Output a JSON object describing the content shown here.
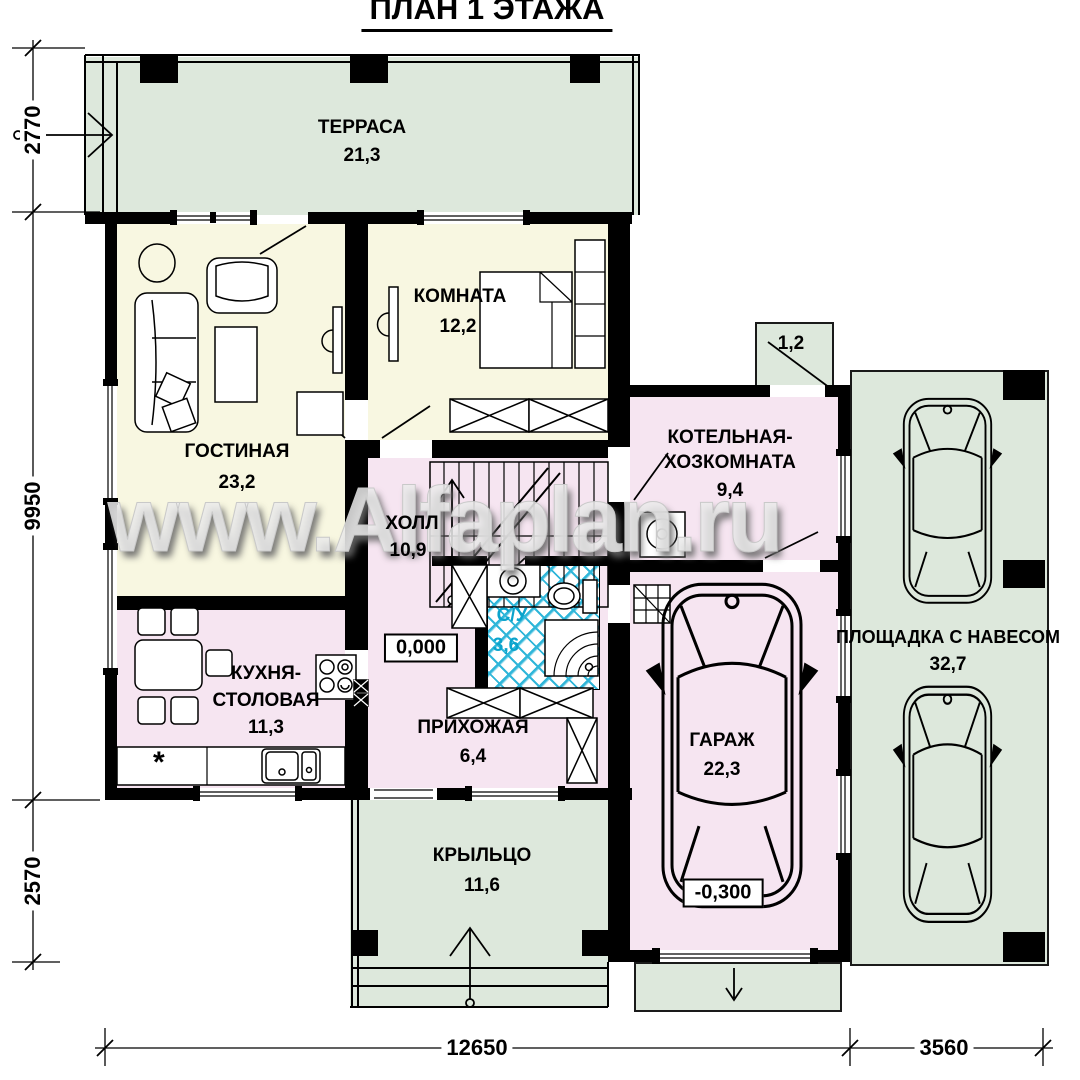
{
  "title": "ПЛАН 1 ЭТАЖА",
  "watermark": "www.Alfaplan.ru",
  "rooms": {
    "terrace": {
      "name": "ТЕРРАСА",
      "area": "21,3"
    },
    "living": {
      "name": "ГОСТИНАЯ",
      "area": "23,2"
    },
    "bedroom": {
      "name": "КОМНАТА",
      "area": "12,2"
    },
    "hall": {
      "name": "ХОЛЛ",
      "area": "10,9"
    },
    "boiler": {
      "name_line1": "КОТЕЛЬНАЯ-",
      "name_line2": "ХОЗКОМНАТА",
      "area": "9,4"
    },
    "kitchen": {
      "name_line1": "КУХНЯ-",
      "name_line2": "СТОЛОВАЯ",
      "area": "11,3",
      "note": "*"
    },
    "wc": {
      "name": "С/У",
      "area": "3,6"
    },
    "entry": {
      "name": "ПРИХОЖАЯ",
      "area": "6,4"
    },
    "porch": {
      "name": "КРЫЛЬЦО",
      "area": "11,6"
    },
    "garage": {
      "name": "ГАРАЖ",
      "area": "22,3"
    },
    "canopy": {
      "name": "ПЛОЩАДКА С НАВЕСОМ",
      "area": "32,7"
    },
    "annex": {
      "area": "1,2"
    }
  },
  "levels": {
    "floor": "0,000",
    "garage": "-0,300"
  },
  "dimensions": {
    "left_top": "2770",
    "left_middle": "9950",
    "left_bottom": "2570",
    "bottom_main": "12650",
    "bottom_right": "3560"
  },
  "colors": {
    "outdoor_green": "#dde8dc",
    "room_yellow": "#f8f7e1",
    "room_pink": "#f6e5f1",
    "tile_cyan": "#2fb6d9",
    "wall_black": "#000000",
    "wc_text_cyan": "#0aa3cc"
  }
}
